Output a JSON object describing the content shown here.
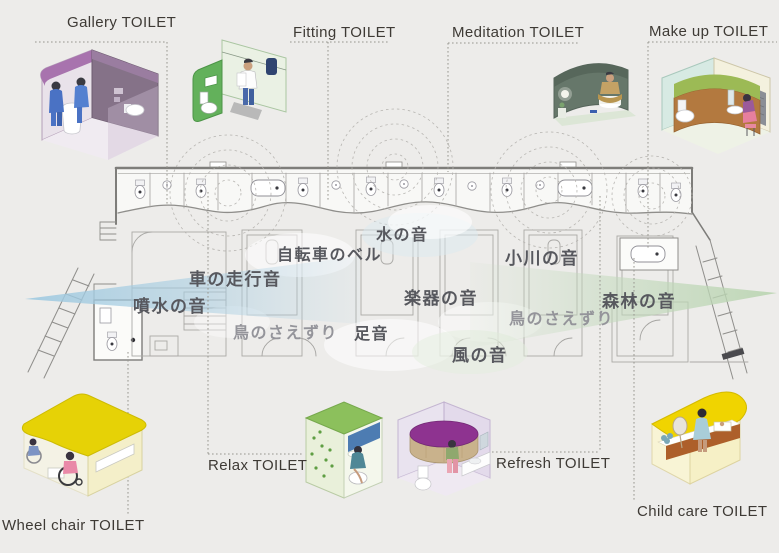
{
  "title_labels": {
    "gallery": "Gallery TOILET",
    "fitting": "Fitting TOILET",
    "meditation": "Meditation TOILET",
    "makeup": "Make up TOILET",
    "wheelchair": "Wheel chair TOILET",
    "relax": "Relax TOILET",
    "refresh": "Refresh TOILET",
    "childcare": "Child care TOILET"
  },
  "sound_labels": {
    "fountain": "噴水の音",
    "car_traffic": "車の走行音",
    "bicycle_bell": "自転車のベル",
    "water": "水の音",
    "stream": "小川の音",
    "instrument": "楽器の音",
    "footsteps": "足音",
    "wind": "風の音",
    "forest": "森林の音",
    "birdsong_left": "鳥のさえずり",
    "birdsong_right": "鳥のさえずり"
  },
  "colors": {
    "background": "#edecea",
    "gallery_accent": "#a873ae",
    "fitting_accent": "#5fae57",
    "meditation_accent": "#66776a",
    "makeup_accent": "#9cba55",
    "wheelchair_accent": "#e6d206",
    "relax_accent": "#8cc05c",
    "refresh_accent": "#8e3390",
    "childcare_accent": "#f0d400",
    "left_sound_wedge": "#9ec9e0",
    "right_sound_wedge": "#b9d4b0",
    "label_text": "#3e3a35",
    "sound_text": "#57585e"
  }
}
